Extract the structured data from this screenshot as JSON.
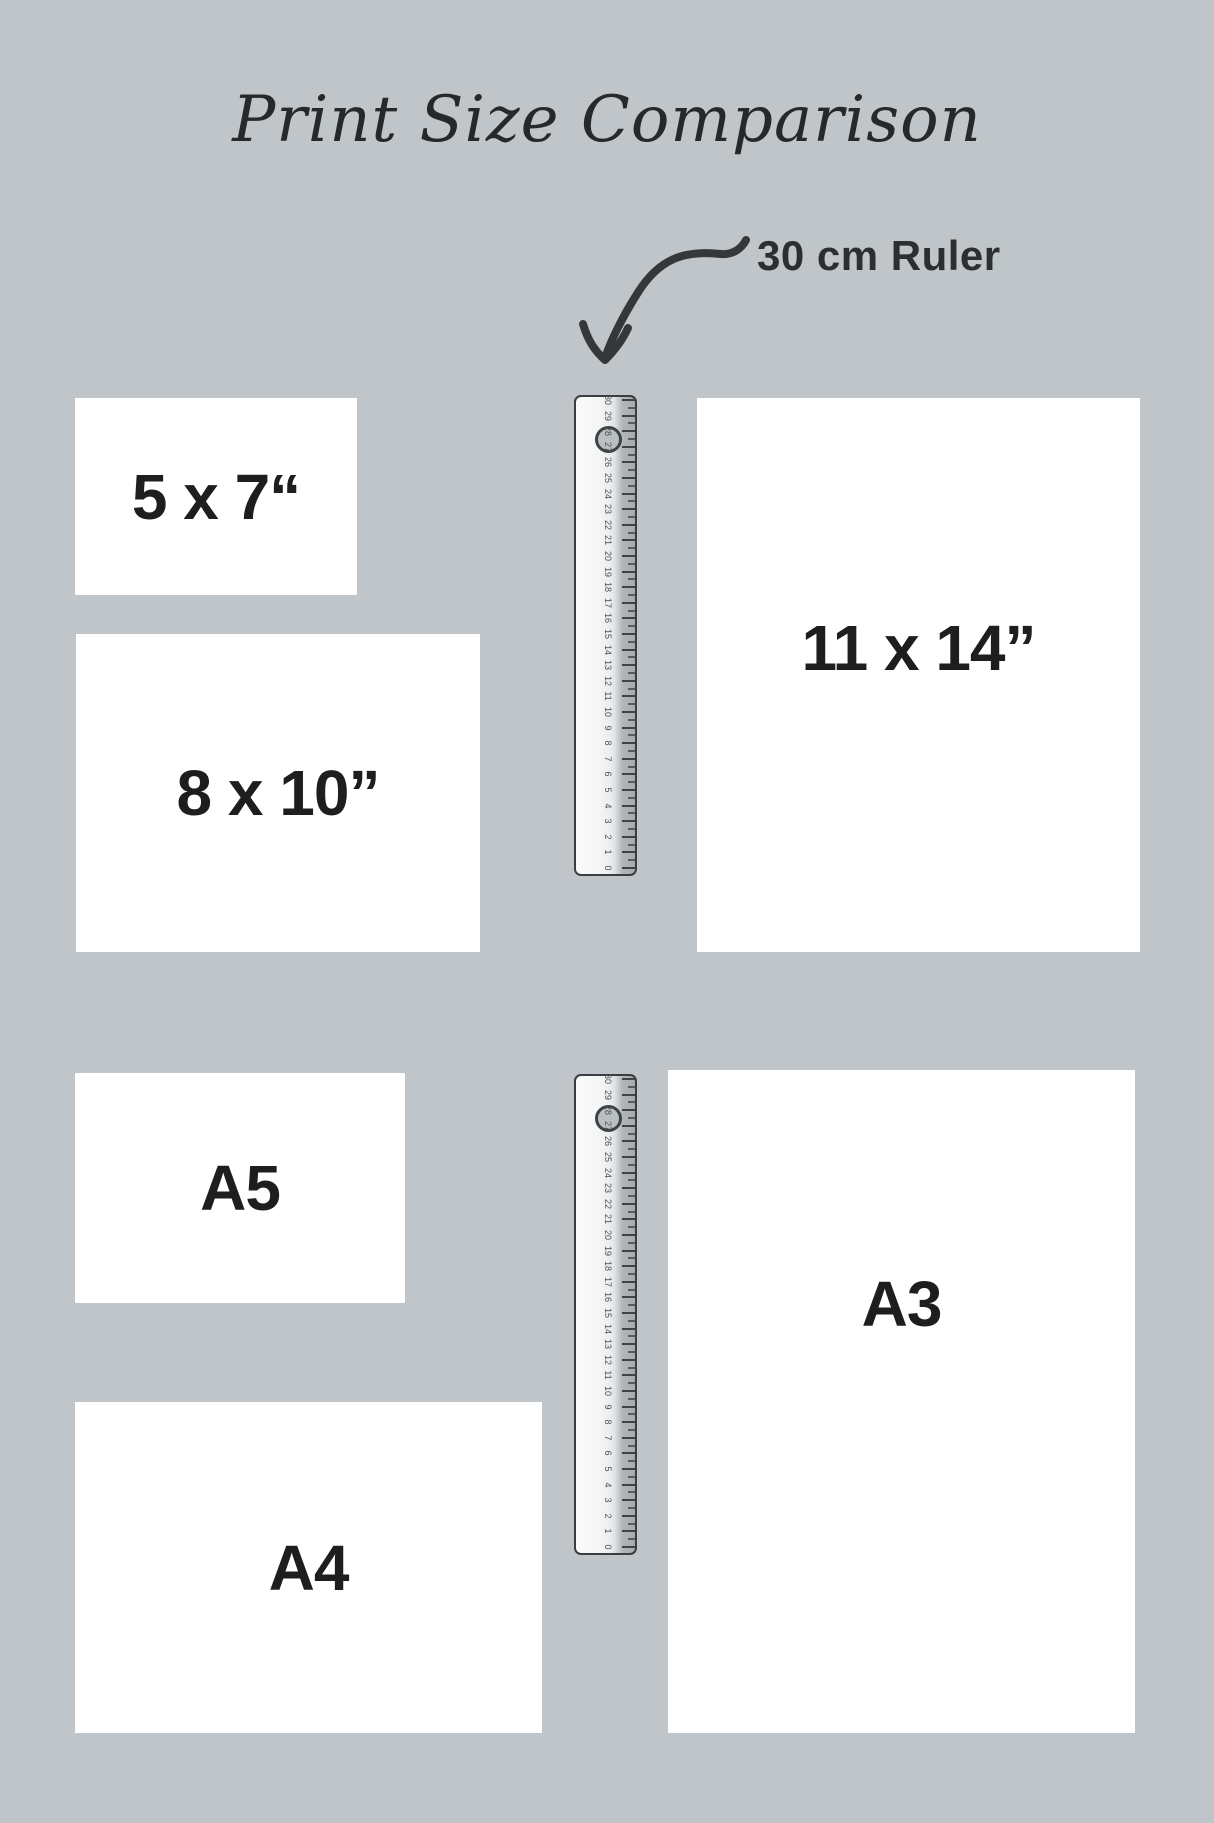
{
  "title": "Print Size Comparison",
  "ruler_callout": {
    "label": "30 cm Ruler"
  },
  "prints": [
    {
      "id": "5x7",
      "label": "5 x 7“"
    },
    {
      "id": "8x10",
      "label": "8 x 10”"
    },
    {
      "id": "11x14",
      "label": "11 x 14”"
    },
    {
      "id": "a5",
      "label": "A5"
    },
    {
      "id": "a4",
      "label": "A4"
    },
    {
      "id": "a3",
      "label": "A3"
    }
  ],
  "rulers": [
    {
      "id": "ruler-top",
      "length_cm": 30,
      "tick_numbers": [
        30,
        29,
        28,
        27,
        26,
        25,
        24,
        23,
        22,
        21,
        20,
        19,
        18,
        17,
        16,
        15,
        14,
        13,
        12,
        11,
        10,
        9,
        8,
        7,
        6,
        5,
        4,
        3,
        2,
        1,
        0
      ]
    },
    {
      "id": "ruler-bottom",
      "length_cm": 30,
      "tick_numbers": [
        30,
        29,
        28,
        27,
        26,
        25,
        24,
        23,
        22,
        21,
        20,
        19,
        18,
        17,
        16,
        15,
        14,
        13,
        12,
        11,
        10,
        9,
        8,
        7,
        6,
        5,
        4,
        3,
        2,
        1,
        0
      ]
    }
  ],
  "colors": {
    "background": "#bfc5c8",
    "paper": "#ffffff",
    "text": "#1e1e1e",
    "arrow": "#35383a",
    "ruler_border": "#3a3e41"
  }
}
